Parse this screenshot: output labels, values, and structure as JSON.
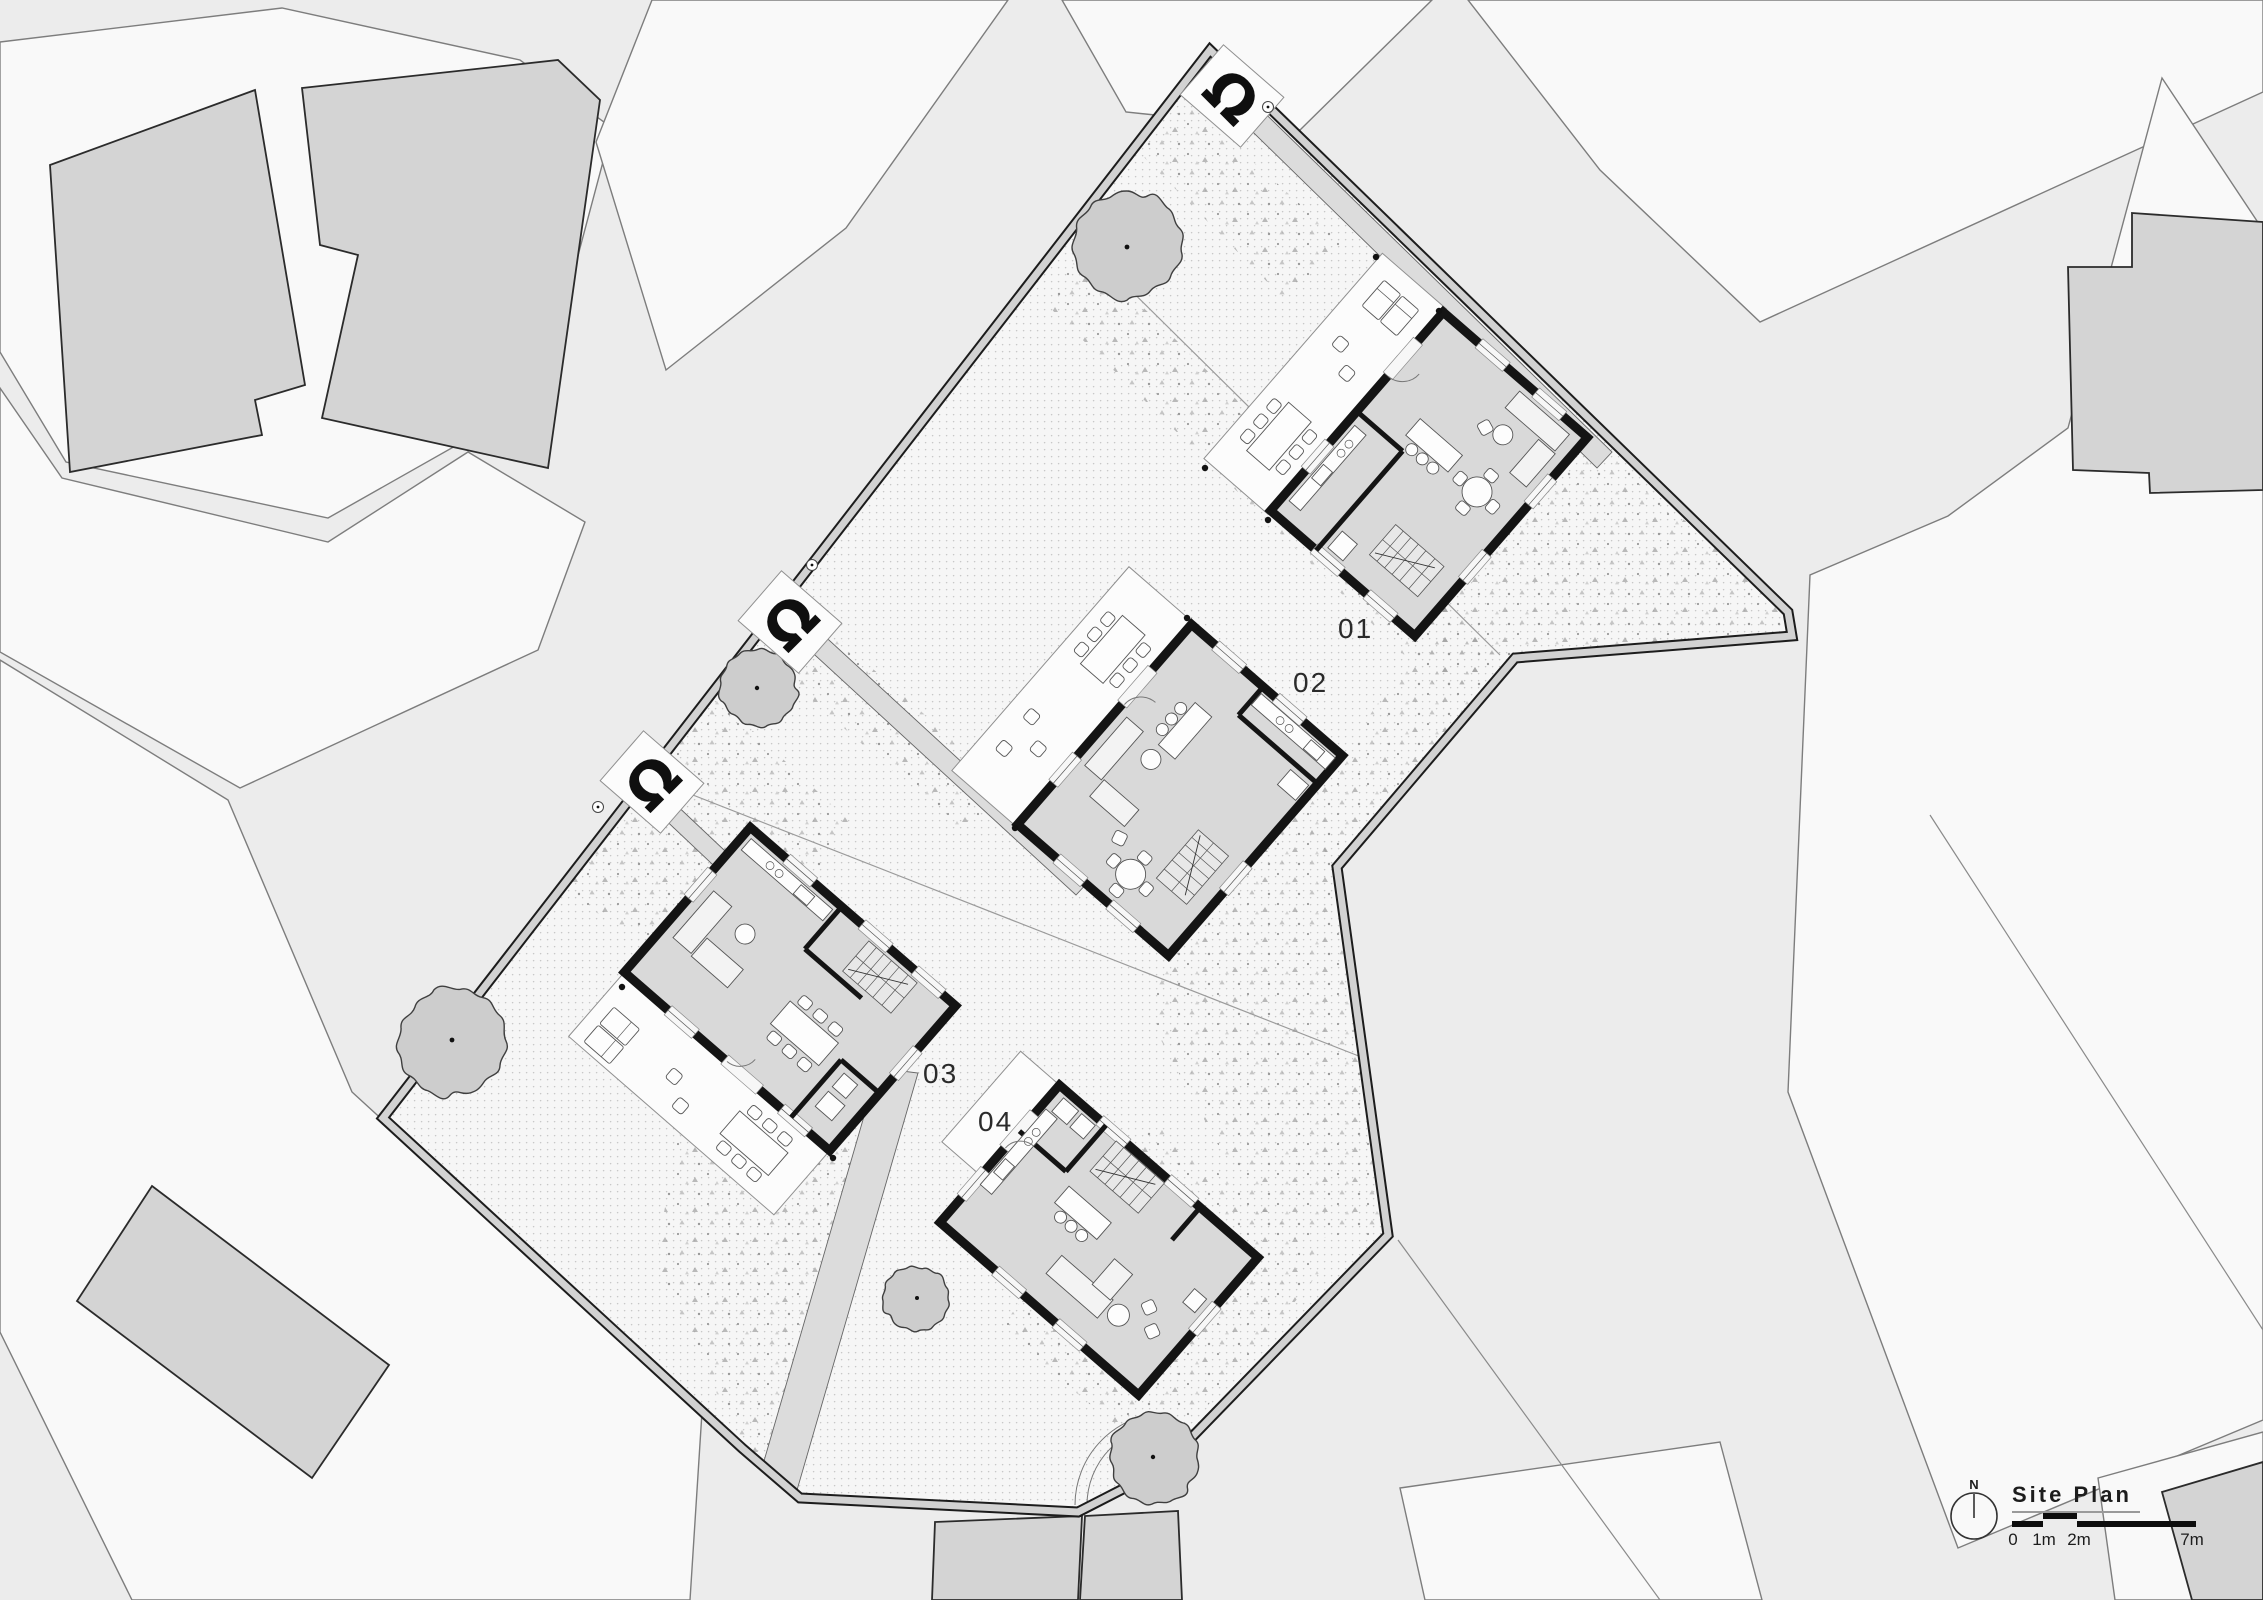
{
  "drawing": {
    "kind": "architectural site plan",
    "plan_label_style": "numbered houses"
  },
  "title_block": {
    "title": "Site Plan",
    "north_label": "N",
    "scale_ticks": [
      "0",
      "1m",
      "2m",
      "7m"
    ]
  },
  "plots": [
    {
      "label": "01"
    },
    {
      "label": "02"
    },
    {
      "label": "03"
    },
    {
      "label": "04"
    }
  ],
  "markers": {
    "entry_marker_glyph": "Ω"
  },
  "colors": {
    "background": "#ececec",
    "parcel": "#f9f9f9",
    "context_building": "#d4d4d4",
    "site_fill": "#f6f6f6",
    "boundary_dark": "#1c1c1c",
    "boundary_light": "#d2d2d2",
    "house_wall": "#141414",
    "house_floor": "#d9d9d9",
    "terrace": "#fcfcfc",
    "path": "#dcdcdc",
    "tree": "#cdcdcd",
    "label_text": "#2a2a2a"
  }
}
